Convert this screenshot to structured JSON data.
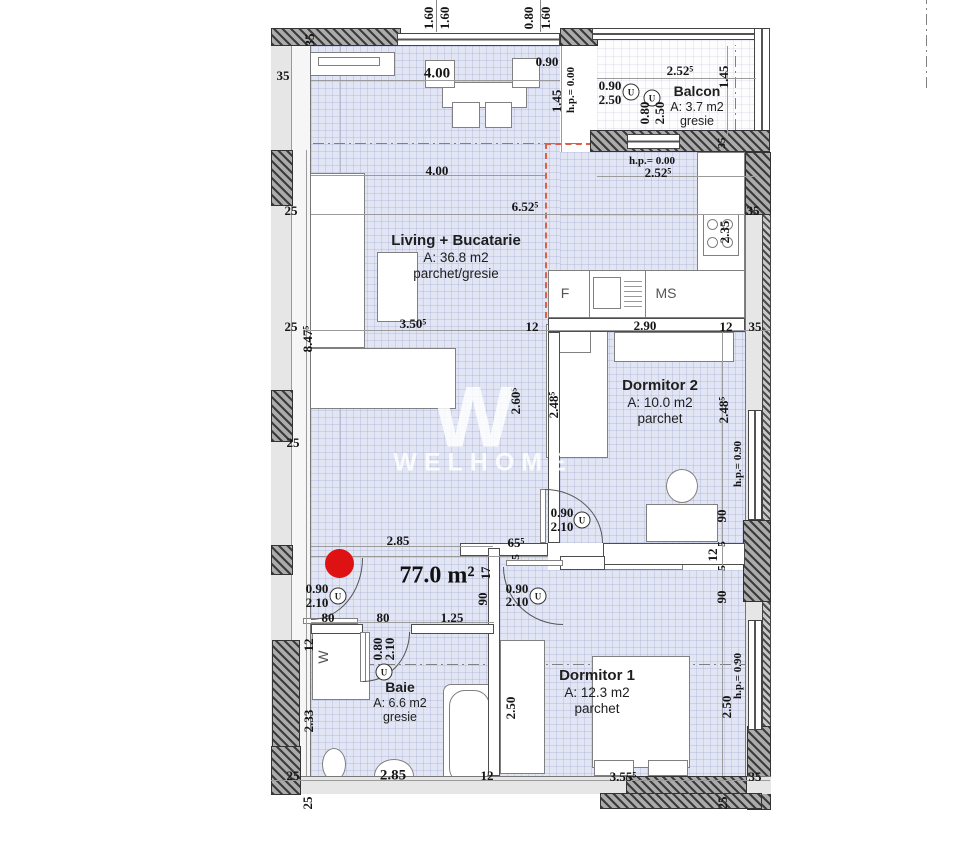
{
  "watermark": {
    "letter": "W",
    "brand": "WELHOME"
  },
  "total_area": "77.0 m²",
  "rooms": {
    "living": {
      "name": "Living + Bucatarie",
      "area": "A: 36.8 m2",
      "floor": "parchet/gresie"
    },
    "balcon": {
      "name": "Balcon",
      "area": "A: 3.7 m2",
      "floor": "gresie"
    },
    "dormitor2": {
      "name": "Dormitor 2",
      "area": "A: 10.0 m2",
      "floor": "parchet"
    },
    "dormitor1": {
      "name": "Dormitor 1",
      "area": "A: 12.3 m2",
      "floor": "parchet"
    },
    "baie": {
      "name": "Baie",
      "area": "A: 6.6 m2",
      "floor": "gresie"
    }
  },
  "appliances": {
    "fridge": "F",
    "washer": "MS",
    "wardrobe": "W",
    "door_symbol": "U"
  },
  "dims": {
    "top_win1_a": "1.60",
    "top_win1_b": "1.60",
    "top_win2_a": "0.80",
    "top_win2_b": "1.60",
    "wall35_tl_v": "35",
    "wall35_tl_h": "35",
    "win_400": "4.00",
    "win_090": "0.90",
    "v145_kit": "1.45",
    "hp000_v": "h.p.= 0.00",
    "bal_door_w": "0.90",
    "bal_door_h": "2.50",
    "bal_win_w": "0.80",
    "bal_win_h": "2.50",
    "bal_2525": "2.52⁵",
    "bal_145": "1.45",
    "bal_35": "35",
    "hp000_h": "h.p.= 0.00",
    "kit_2525": "2.52⁵",
    "living_400": "4.00",
    "living_6525": "6.52⁵",
    "l25a": "25",
    "l25b": "25",
    "l25c": "25",
    "living_3505": "3.50⁵",
    "t12a": "12",
    "d2_290": "2.90",
    "t12b": "12",
    "r35a": "35",
    "r35b": "35",
    "stove_235": "2.35",
    "v8475": "8.47⁵",
    "v2605": "2.60⁵",
    "v2485a": "2.48⁵",
    "v2485b": "2.48⁵",
    "hp090a": "h.p.= 0.90",
    "hp090b": "h.p.= 0.90",
    "v90a": "90",
    "v5a": "5",
    "v12a": "12",
    "v5b": "5",
    "v90b": "90",
    "h65": "65⁵",
    "h5": "5",
    "v17": "17",
    "v90c": "90",
    "hall_285": "2.85",
    "hall_80a": "80",
    "hall_80b": "80",
    "hall_125": "1.25",
    "edoor_090": "0.90",
    "edoor_210": "2.10",
    "d2door_090": "0.90",
    "d2door_210": "2.10",
    "d1door_090": "0.90",
    "d1door_210": "2.10",
    "bathdoor_080": "0.80",
    "bathdoor_210": "2.10",
    "v12w": "12",
    "v233": "2.33",
    "v250a": "2.50",
    "v250b": "2.50",
    "bot25a": "25",
    "bot25b": "25",
    "bot285": "2.85",
    "bot12": "12",
    "bot3555": "3.55⁵",
    "bot35": "35",
    "r25rot": "25"
  }
}
